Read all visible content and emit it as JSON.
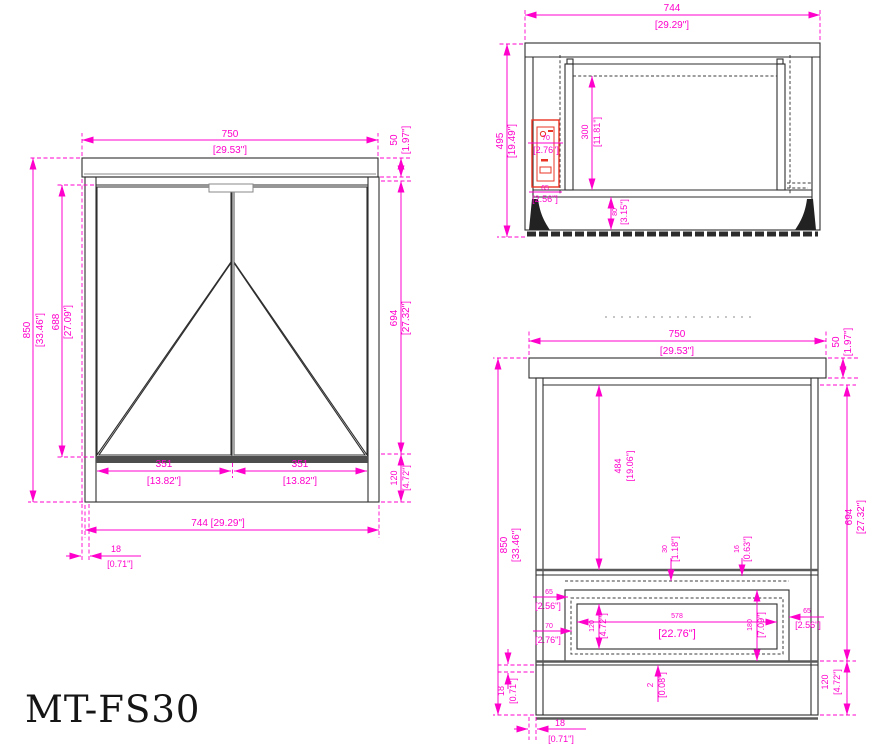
{
  "title": "MT-FS30",
  "colors": {
    "dimension_color": "#ff00cc",
    "highlight_color": "#e93425",
    "line_color": "#2e2e2e"
  },
  "views": {
    "front": {
      "name": "front-view",
      "dims": {
        "top_width": {
          "mm": "750",
          "in": "[29.53\"]"
        },
        "top_thickness": {
          "mm": "50",
          "in": "[1.97\"]"
        },
        "overall_height": {
          "mm": "850",
          "in": "[33.46\"]"
        },
        "door_height": {
          "mm": "688",
          "in": "[27.09\"]"
        },
        "side_height": {
          "mm": "694",
          "in": "[27.32\"]"
        },
        "base_height": {
          "mm": "120",
          "in": "[4.72\"]"
        },
        "left_door_width": {
          "mm": "351",
          "in": "[13.82\"]"
        },
        "right_door_width": {
          "mm": "351",
          "in": "[13.82\"]"
        },
        "body_width": {
          "label": "744 [29.29\"]"
        },
        "panel_thickness": {
          "mm": "18",
          "in": "[0.71\"]"
        }
      }
    },
    "section": {
      "name": "section-view",
      "dims": {
        "body_width": {
          "mm": "744",
          "in": "[29.29\"]"
        },
        "interior_height": {
          "mm": "495",
          "in": "[19.49\"]"
        },
        "insert_height": {
          "mm": "300",
          "in": "[11.81\"]"
        },
        "outlet_height": {
          "mm": "70",
          "in": "[2.76\"]"
        },
        "outlet_offset": {
          "mm": "65",
          "in": "[2.56\"]"
        },
        "base_height": {
          "mm": "80",
          "in": "[3.15\"]"
        }
      }
    },
    "back": {
      "name": "back-view",
      "dims": {
        "top_width": {
          "mm": "750",
          "in": "[29.53\"]"
        },
        "top_thickness": {
          "mm": "50",
          "in": "[1.97\"]"
        },
        "overall_height": {
          "mm": "850",
          "in": "[33.46\"]"
        },
        "back_panel_height": {
          "mm": "484",
          "in": "[19.06\"]"
        },
        "side_height": {
          "mm": "694",
          "in": "[27.32\"]"
        },
        "base_height": {
          "mm": "120",
          "in": "[4.72\"]"
        },
        "rail_offset": {
          "mm": "30",
          "in": "[1.18\"]"
        },
        "lip_offset": {
          "mm": "16",
          "in": "[0.63\"]"
        },
        "cutout_width": {
          "mm": "578",
          "in": "[22.76\"]"
        },
        "cutout_height": {
          "mm": "120",
          "in": "[4.72\"]"
        },
        "opening_height": {
          "mm": "180",
          "in": "[7.09\"]"
        },
        "left_offset_top": {
          "mm": "65",
          "in": "[2.56\"]"
        },
        "left_offset_bottom": {
          "mm": "70",
          "in": "[2.76\"]"
        },
        "right_offset": {
          "mm": "65",
          "in": "[2.56\"]"
        },
        "gap": {
          "mm": "2",
          "in": "[0.08\"]"
        },
        "rail_thickness": {
          "mm": "18",
          "in": "[0.71\"]"
        },
        "bottom_offset": {
          "mm": "18",
          "in": "[0.71\"]"
        }
      }
    }
  }
}
